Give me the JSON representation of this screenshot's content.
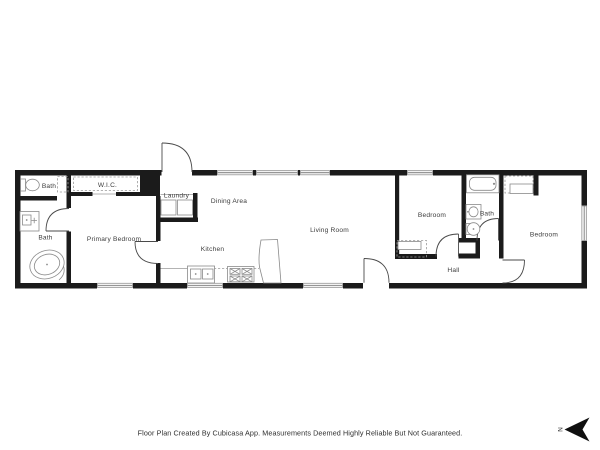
{
  "colors": {
    "page_bg": "#ffffff",
    "wall": "#1b1b1b",
    "fixture_line": "#8a8a8a",
    "door_line": "#4a4a4a",
    "window_frame": "#9a9a9a",
    "label_text": "#3c3c3c"
  },
  "rooms": {
    "bath_small": "Bath",
    "wic": "W.I.C.",
    "bath_primary": "Bath",
    "primary_bedroom": "Primary Bedroom",
    "laundry": "Laundry",
    "dining": "Dining Area",
    "kitchen": "Kitchen",
    "living": "Living Room",
    "bedroom_middle": "Bedroom",
    "bath_hall": "Bath",
    "hall": "Hall",
    "bedroom_right": "Bedroom"
  },
  "footer": {
    "disclaimer": "Floor Plan Created By Cubicasa App. Measurements Deemed Highly Reliable But Not Guaranteed."
  },
  "compass": {
    "north_label": "N"
  }
}
